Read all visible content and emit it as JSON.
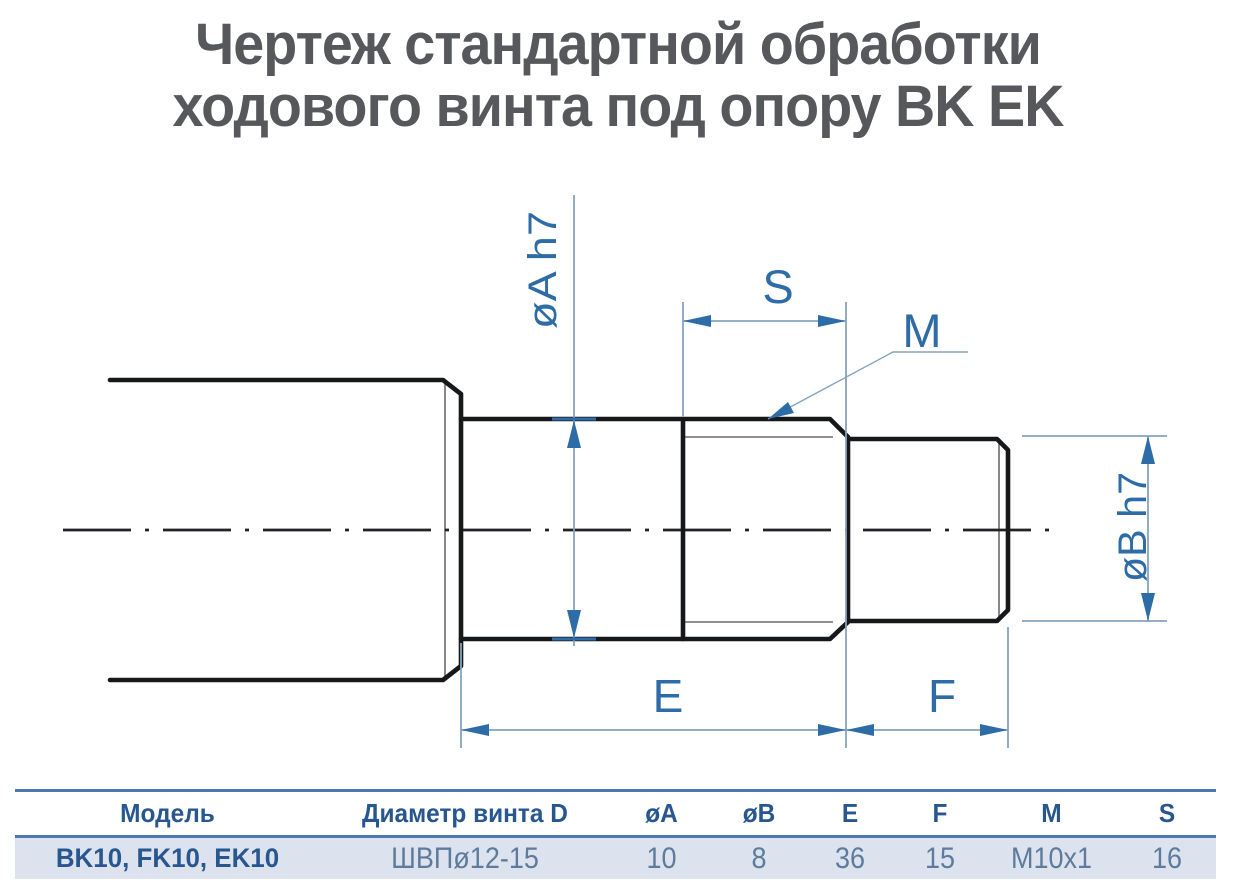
{
  "title": {
    "line1": "Чертеж стандартной обработки",
    "line2": "ходового винта под опору BK EK"
  },
  "drawing": {
    "labels": {
      "dia_a": "øA h7",
      "s": "S",
      "m": "M",
      "dia_b": "øB h7",
      "e": "E",
      "f": "F"
    },
    "colors": {
      "outline": "#17181a",
      "thin_edge": "#6a6b6e",
      "dimension_line": "#86a3c0",
      "dimension_accent": "#2e6ca7",
      "label_text": "#2e6ca7"
    }
  },
  "table": {
    "headers": [
      "Модель",
      "Диаметр винта D",
      "øA",
      "øB",
      "E",
      "F",
      "M",
      "S"
    ],
    "rows": [
      [
        "BK10, FK10, EK10",
        "ШВПø12-15",
        "10",
        "8",
        "36",
        "15",
        "M10x1",
        "16"
      ]
    ],
    "colors": {
      "border": "#4a79b0",
      "header_text": "#28568e",
      "row_background": "#dce3ef",
      "value_text": "#5e7b9c"
    }
  }
}
